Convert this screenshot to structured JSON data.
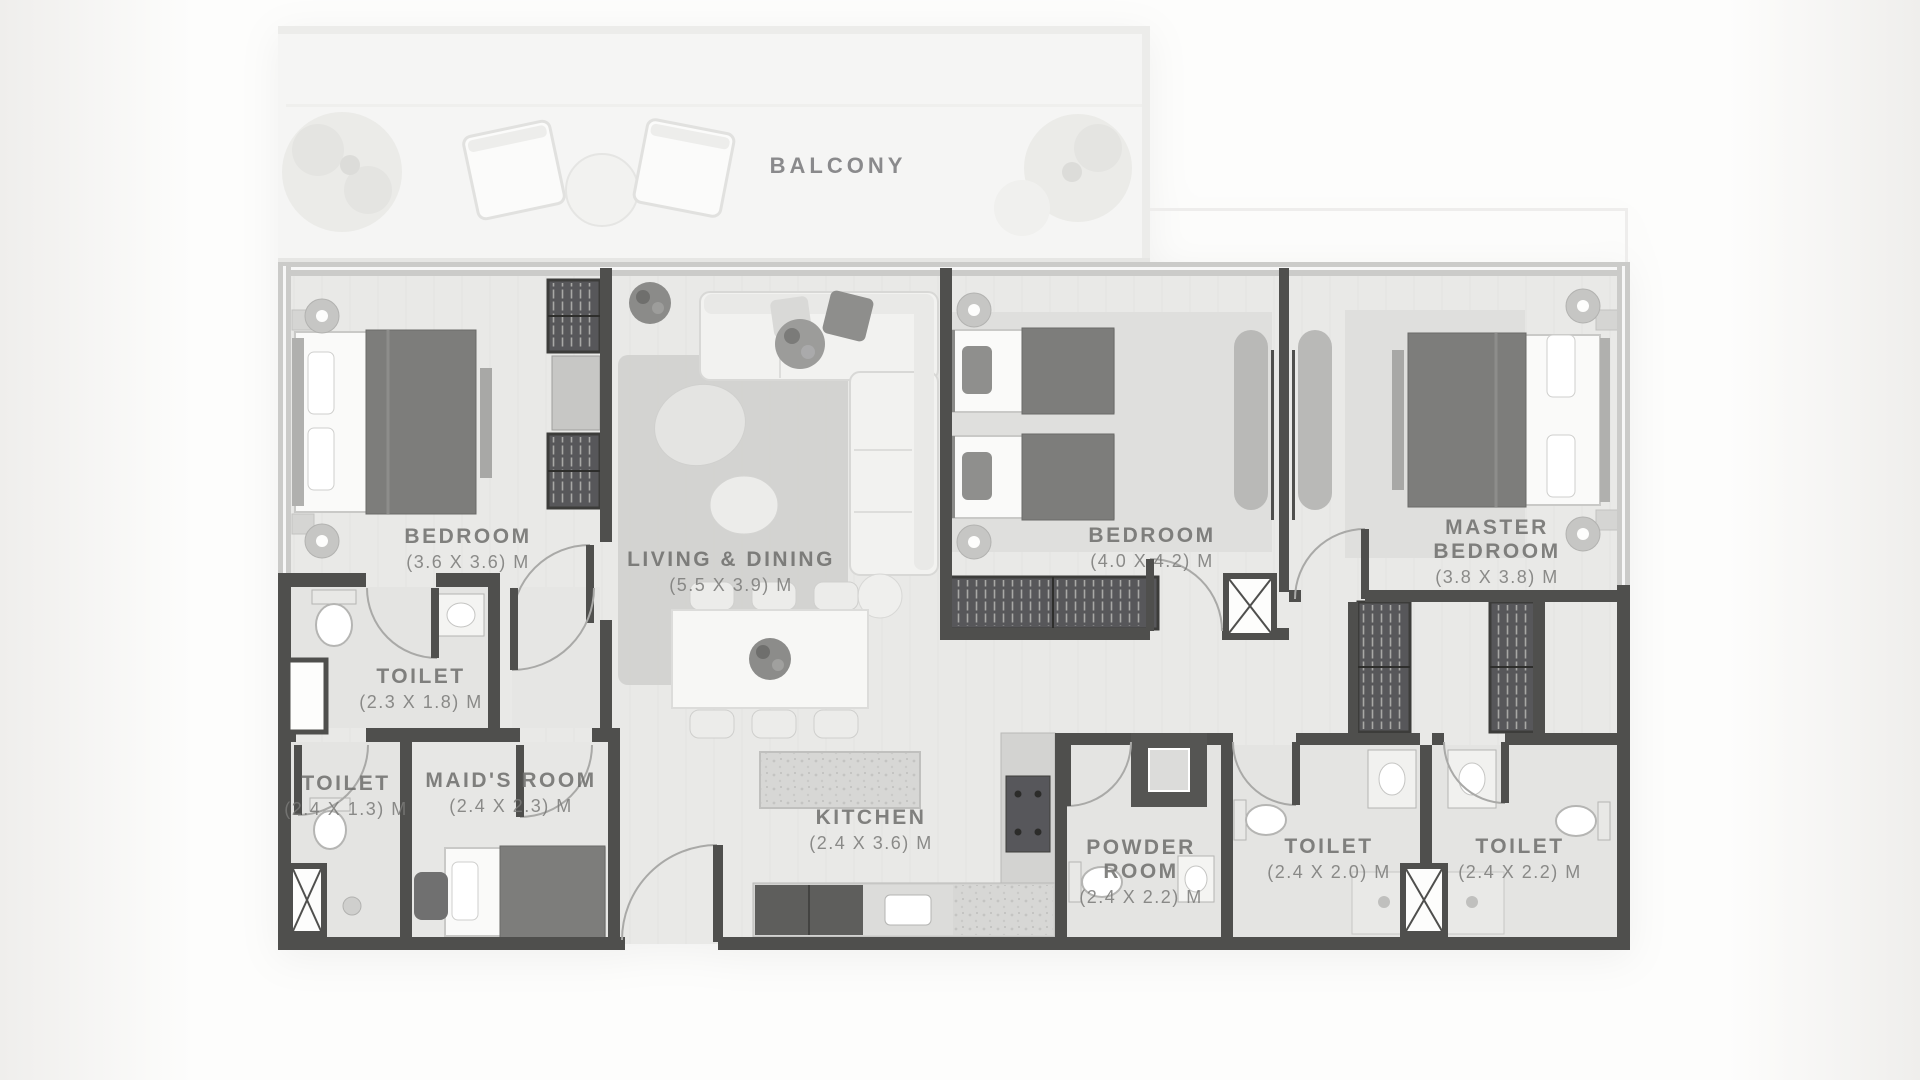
{
  "plan_type": "apartment-floor-plan",
  "colors": {
    "background": "#fdfdfc",
    "wall_dark": "#4f4f4d",
    "wall_window": "#cbcbc9",
    "floor": "#e9e9e7",
    "furniture_dark": "#7d7d7b",
    "label_text": "#6e6e6c",
    "dims_text": "#7a7a78"
  },
  "rooms": [
    {
      "id": "balcony",
      "name": "BALCONY",
      "lines": [
        "BALCONY"
      ],
      "dims": ""
    },
    {
      "id": "bedroom-1",
      "name": "BEDROOM",
      "lines": [
        "BEDROOM"
      ],
      "dims": "(3.6 X 3.6) M"
    },
    {
      "id": "living-dining",
      "name": "LIVING & DINING",
      "lines": [
        "LIVING & DINING"
      ],
      "dims": "(5.5 X 3.9) M"
    },
    {
      "id": "bedroom-2",
      "name": "BEDROOM",
      "lines": [
        "BEDROOM"
      ],
      "dims": "(4.0 X 4.2) M"
    },
    {
      "id": "master-bedroom",
      "name": "MASTER BEDROOM",
      "lines": [
        "MASTER",
        "BEDROOM"
      ],
      "dims": "(3.8 X 3.8) M"
    },
    {
      "id": "toilet-1",
      "name": "TOILET",
      "lines": [
        "TOILET"
      ],
      "dims": "(2.3 X 1.8) M"
    },
    {
      "id": "toilet-2",
      "name": "TOILET",
      "lines": [
        "TOILET"
      ],
      "dims": "(2.4 X 1.3) M"
    },
    {
      "id": "maids-room",
      "name": "MAID'S ROOM",
      "lines": [
        "MAID'S ROOM"
      ],
      "dims": "(2.4 X 2.3) M"
    },
    {
      "id": "kitchen",
      "name": "KITCHEN",
      "lines": [
        "KITCHEN"
      ],
      "dims": "(2.4 X 3.6) M"
    },
    {
      "id": "powder-room",
      "name": "POWDER ROOM",
      "lines": [
        "POWDER",
        "ROOM"
      ],
      "dims": "(2.4 X 2.2) M"
    },
    {
      "id": "toilet-3",
      "name": "TOILET",
      "lines": [
        "TOILET"
      ],
      "dims": "(2.4 X 2.0) M"
    },
    {
      "id": "toilet-4",
      "name": "TOILET",
      "lines": [
        "TOILET"
      ],
      "dims": "(2.4 X 2.2) M"
    }
  ]
}
